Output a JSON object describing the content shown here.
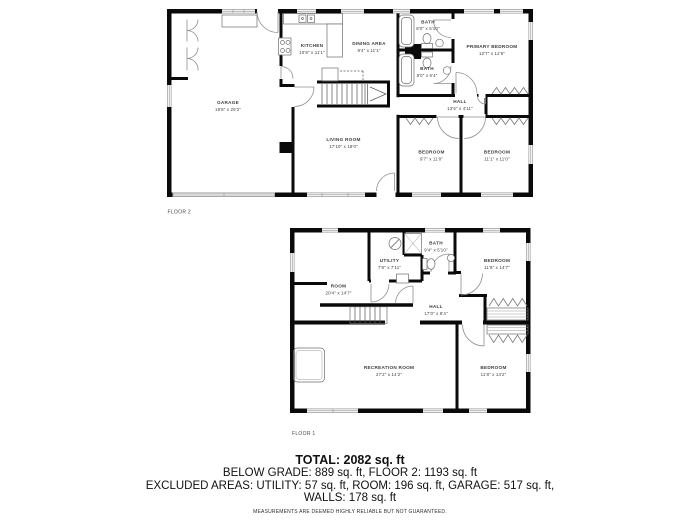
{
  "floor2": {
    "label": "FLOOR 2",
    "garage": {
      "name": "GARAGE",
      "dims": "19'8\" x 29'2\""
    },
    "kitchen": {
      "name": "KITCHEN",
      "dims": "10'8\" x 11'1\""
    },
    "dining": {
      "name": "DINING AREA",
      "dims": "9'4\" x 11'1\""
    },
    "living": {
      "name": "LIVING ROOM",
      "dims": "17'10\" x 18'0\""
    },
    "bath1": {
      "name": "BATH",
      "dims": "8'0\" x 5'10\""
    },
    "bath2": {
      "name": "BATH",
      "dims": "8'0\" x 6'4\""
    },
    "primary": {
      "name": "PRIMARY BEDROOM",
      "dims": "12'7\" x 12'6\""
    },
    "hall": {
      "name": "HALL",
      "dims": "13'5\" x 4'11\""
    },
    "bedroom1": {
      "name": "BEDROOM",
      "dims": "9'7\" x 11'0\""
    },
    "bedroom2": {
      "name": "BEDROOM",
      "dims": "11'1\" x 11'0\""
    }
  },
  "floor1": {
    "label": "FLOOR 1",
    "utility": {
      "name": "UTILITY",
      "dims": "7'8\" x 7'11\""
    },
    "bath": {
      "name": "BATH",
      "dims": "9'4\" x 5'10\""
    },
    "bedroom1": {
      "name": "BEDROOM",
      "dims": "11'8\" x 14'7\""
    },
    "room": {
      "name": "ROOM",
      "dims": "20'4\" x 14'7\""
    },
    "hall": {
      "name": "HALL",
      "dims": "17'0\" x 8'4\""
    },
    "recreation": {
      "name": "RECREATION ROOM",
      "dims": "27'2\" x 14'2\""
    },
    "bedroom2": {
      "name": "BEDROOM",
      "dims": "11'8\" x 14'2\""
    }
  },
  "summary": {
    "total": "TOTAL: 2082 sq. ft",
    "line1": "BELOW GRADE: 889 sq. ft, FLOOR 2: 1193 sq. ft",
    "line2": "EXCLUDED AREAS: UTILITY: 57 sq. ft, ROOM: 196 sq. ft, GARAGE: 517 sq. ft,",
    "line3": "WALLS: 178 sq. ft",
    "disclaimer": "MEASUREMENTS ARE DEEMED HIGHLY RELIABLE BUT NOT GUARANTEED."
  },
  "colors": {
    "wall": "#0a0a0a",
    "window": "#9a9a9a",
    "label": "#3d3d3d"
  }
}
